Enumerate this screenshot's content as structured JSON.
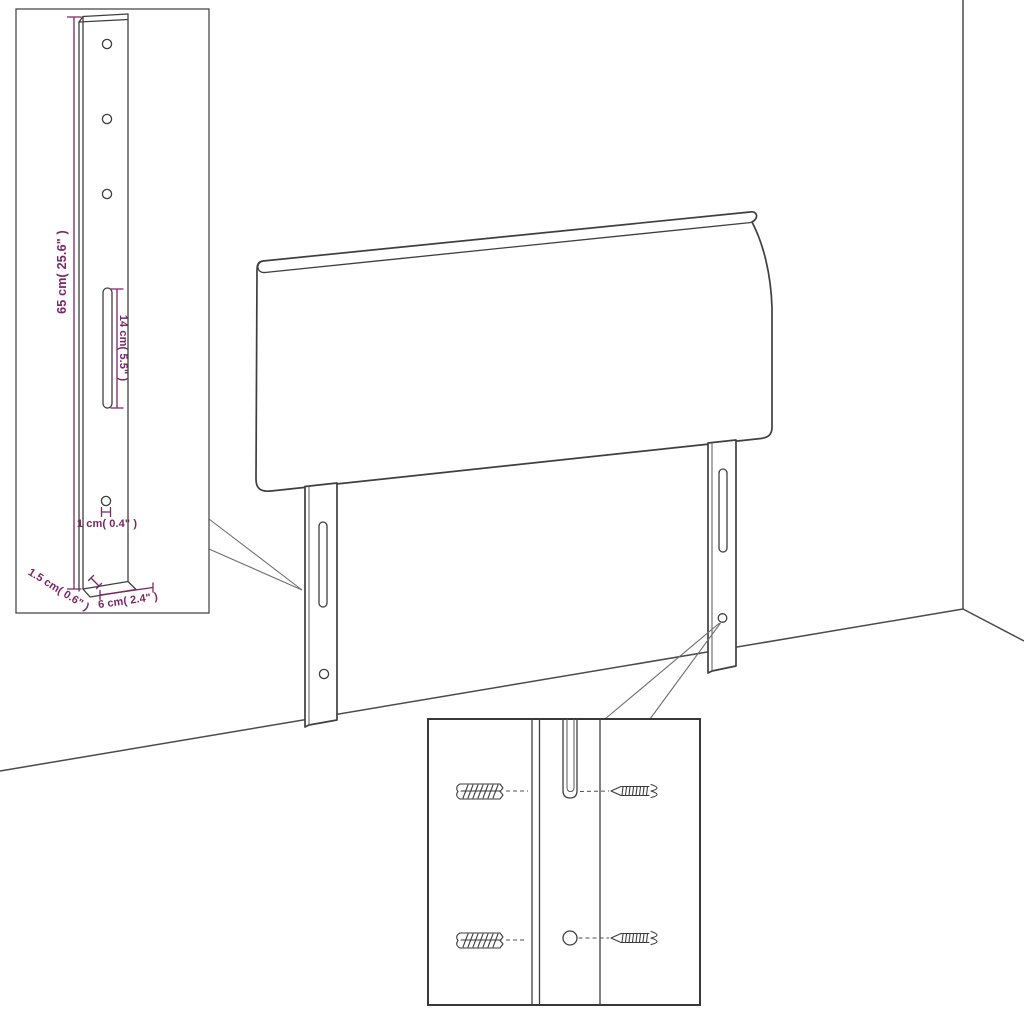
{
  "colors": {
    "line": "#3f3f3f",
    "leader": "#6f6f6f",
    "dimension": "#7d2566",
    "background": "#ffffff"
  },
  "bracket_inset": {
    "height_label": "65 cm( 25.6\" )",
    "slot_label": "14 cm( 5.5\" )",
    "hole_label": "1 cm( 0.4\" )",
    "depth_label": "1.5 cm( 0.6\" )",
    "width_label": "6 cm( 2.4\" )"
  }
}
